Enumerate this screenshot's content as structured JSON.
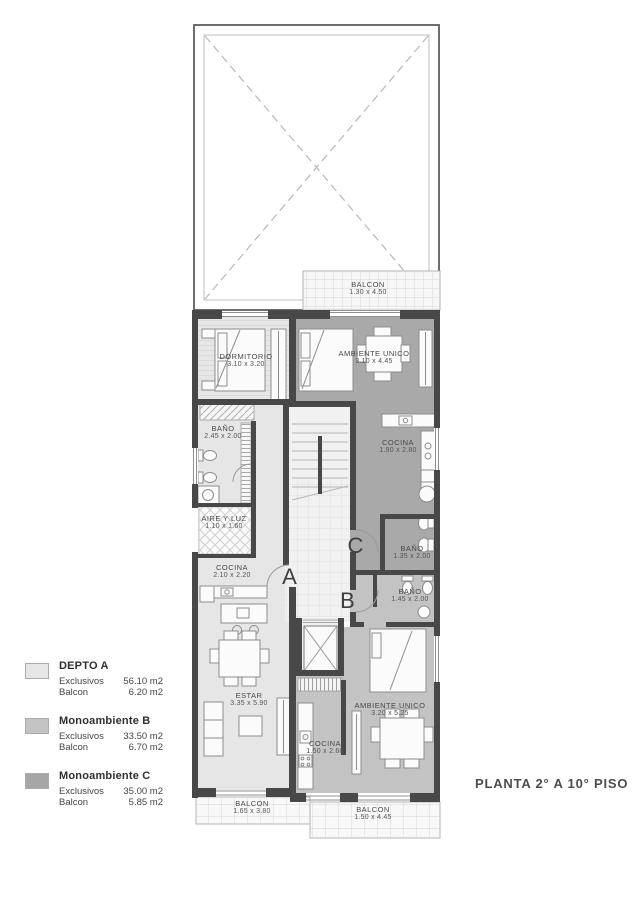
{
  "title": "PLANTA 2° A 10° PISO",
  "legend": {
    "items": [
      {
        "name": "DEPTO A",
        "swatch": "#e6e6e6",
        "rows": [
          {
            "label": "Exclusivos",
            "value": "56.10 m2"
          },
          {
            "label": "Balcon",
            "value": "6.20 m2"
          }
        ]
      },
      {
        "name": "Monoambiente B",
        "swatch": "#c3c3c3",
        "rows": [
          {
            "label": "Exclusivos",
            "value": "33.50 m2"
          },
          {
            "label": "Balcon",
            "value": "6.70 m2"
          }
        ]
      },
      {
        "name": "Monoambiente C",
        "swatch": "#a6a6a6",
        "rows": [
          {
            "label": "Exclusivos",
            "value": "35.00 m2"
          },
          {
            "label": "Balcon",
            "value": "5.85 m2"
          }
        ]
      }
    ]
  },
  "markers": {
    "a": "A",
    "b": "B",
    "c": "C"
  },
  "rooms": {
    "dormitorio": {
      "name": "DORMITORIO",
      "dims": "3.10 x 3.20"
    },
    "ambiente_unico_c": {
      "name": "AMBIENTE UNICO",
      "dims": "3.10 x 4.45"
    },
    "bano_a": {
      "name": "BAÑO",
      "dims": "2.45 x 2.00"
    },
    "cocina_c": {
      "name": "COCINA",
      "dims": "1.90 x 2.80"
    },
    "aire_y_luz": {
      "name": "AIRE Y LUZ",
      "dims": "1.10 x 1.60"
    },
    "bano_c": {
      "name": "BAÑO",
      "dims": "1.35 x 2.00"
    },
    "cocina_a": {
      "name": "COCINA",
      "dims": "2.10 x 2.20"
    },
    "bano_b": {
      "name": "BAÑO",
      "dims": "1.45 x 2.00"
    },
    "estar": {
      "name": "ESTAR",
      "dims": "3.35 x 5.90"
    },
    "ambiente_unico_b": {
      "name": "AMBIENTE UNICO",
      "dims": "3.20 x 5.25"
    },
    "cocina_b": {
      "name": "COCINA",
      "dims": "1.50 x 2.60"
    },
    "balcon_top": {
      "name": "BALCON",
      "dims": "1.30 x 4.50"
    },
    "balcon_bottom_left": {
      "name": "BALCON",
      "dims": "1.65 x 3.80"
    },
    "balcon_bottom_right": {
      "name": "BALCON",
      "dims": "1.50 x 4.45"
    }
  },
  "colors": {
    "unit_a": "#e6e6e6",
    "unit_b": "#c3c3c3",
    "unit_c": "#a9a9a9",
    "wall": "#484848"
  }
}
